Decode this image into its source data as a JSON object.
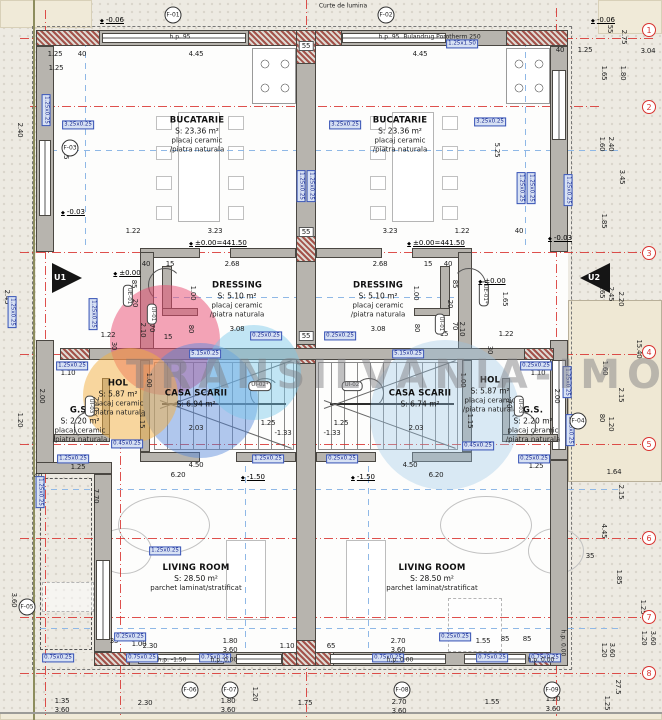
{
  "watermark": {
    "text": "TRANSILVANIA-IMOBILIARE",
    "circles": [
      {
        "x": 165,
        "y": 340,
        "d": 110,
        "c": "rgba(233,74,111,0.50)"
      },
      {
        "x": 200,
        "y": 400,
        "d": 115,
        "c": "rgba(82,133,219,0.45)"
      },
      {
        "x": 130,
        "y": 395,
        "d": 95,
        "c": "rgba(243,176,64,0.50)"
      },
      {
        "x": 253,
        "y": 372,
        "d": 95,
        "c": "rgba(120,200,235,0.45)"
      },
      {
        "x": 445,
        "y": 415,
        "d": 150,
        "c": "rgba(150,195,230,0.35)"
      }
    ]
  },
  "entrances": [
    {
      "label": "U1"
    },
    {
      "label": "U2"
    }
  ],
  "rooms": [
    {
      "name": "BUCATARIE",
      "area": "S: 23.36 m²",
      "f1": "placaj ceramic",
      "f2": "/piatra naturala",
      "x": 197,
      "y": 135
    },
    {
      "name": "BUCATARIE",
      "area": "S: 23.36 m²",
      "f1": "placaj ceramic",
      "f2": "/piatra naturala",
      "x": 400,
      "y": 135
    },
    {
      "name": "DRESSING",
      "area": "S: 5.10 m²",
      "f1": "placaj ceramic",
      "f2": "/piatra naturala",
      "x": 237,
      "y": 300
    },
    {
      "name": "DRESSING",
      "area": "S: 5.10 m²",
      "f1": "placaj ceramic",
      "f2": "/piatra naturala",
      "x": 378,
      "y": 300
    },
    {
      "name": "HOL",
      "area": "S: 5.87 m²",
      "f1": "placaj ceramic",
      "f2": "/piatra naturala",
      "x": 118,
      "y": 398
    },
    {
      "name": "HOL",
      "area": "S: 5.87 m²",
      "f1": "placaj ceramic",
      "f2": "/piatra naturala",
      "x": 490,
      "y": 395
    },
    {
      "name": "CASA SCARII",
      "area": "S: 6.94 m²",
      "x": 196,
      "y": 399
    },
    {
      "name": "CASA SCARII",
      "area": "S: 6.74 m²",
      "x": 420,
      "y": 399
    },
    {
      "name": "G.S.",
      "area": "S: 2.20 m²",
      "f1": "placaj ceramic",
      "f2": "/piatra naturala",
      "x": 80,
      "y": 425
    },
    {
      "name": "G.S.",
      "area": "S: 2.20 m²",
      "f1": "placaj ceramic",
      "f2": "/piatra naturala",
      "x": 533,
      "y": 425
    },
    {
      "name": "LIVING ROOM",
      "area": "S: 28.50 m²",
      "f1": "parchet laminat/stratificat",
      "x": 196,
      "y": 578
    },
    {
      "name": "LIVING ROOM",
      "area": "S: 28.50 m²",
      "f1": "parchet laminat/stratificat",
      "x": 432,
      "y": 578
    }
  ],
  "annot": {
    "dims": [
      [
        "1.25",
        55,
        54
      ],
      [
        "40",
        82,
        54
      ],
      [
        "4.45",
        196,
        54
      ],
      [
        "4.45",
        420,
        54
      ],
      [
        "40",
        560,
        50
      ],
      [
        "1.25",
        585,
        50
      ],
      [
        "3.04",
        648,
        51
      ],
      [
        "55",
        610,
        29,
        90
      ],
      [
        "2.75",
        624,
        37,
        90
      ],
      [
        "1.25",
        56,
        68
      ],
      [
        "1.65",
        604,
        73,
        90
      ],
      [
        "1.80",
        623,
        73,
        90
      ],
      [
        "1.60",
        602,
        144,
        90
      ],
      [
        "2.40",
        611,
        144,
        90
      ],
      [
        "3.45",
        622,
        177,
        90
      ],
      [
        "1.85",
        604,
        221,
        90
      ],
      [
        "1.65",
        602,
        291,
        90
      ],
      [
        "2.45",
        611,
        294,
        90
      ],
      [
        "2.20",
        621,
        299,
        90
      ],
      [
        "15.40",
        639,
        349,
        90
      ],
      [
        "1.60",
        605,
        368,
        90
      ],
      [
        "2.15",
        621,
        395,
        90
      ],
      [
        "80",
        602,
        418,
        90
      ],
      [
        "1.20",
        611,
        424,
        90
      ],
      [
        "1.64",
        614,
        472
      ],
      [
        "2.15",
        621,
        492,
        90
      ],
      [
        "4.45",
        604,
        531,
        90
      ],
      [
        "35",
        590,
        556
      ],
      [
        "1.85",
        619,
        577,
        90
      ],
      [
        "1.25",
        643,
        607,
        90
      ],
      [
        "1.20",
        604,
        650,
        90
      ],
      [
        "3.60",
        612,
        650,
        90
      ],
      [
        "27.5",
        618,
        687,
        90
      ],
      [
        "1.20",
        644,
        638,
        90
      ],
      [
        "3.60",
        653,
        638,
        90
      ],
      [
        "2.40",
        20,
        130,
        90
      ],
      [
        "2.45",
        7,
        297,
        90
      ],
      [
        "1.20",
        20,
        420,
        90
      ],
      [
        "2.00",
        42,
        396,
        90
      ],
      [
        "3.60",
        14,
        600,
        90
      ],
      [
        "7.70",
        96,
        496,
        90
      ],
      [
        "5.25",
        66,
        152,
        90
      ],
      [
        "5.25",
        497,
        150,
        90
      ],
      [
        "1.22",
        133,
        231
      ],
      [
        "3.23",
        215,
        231
      ],
      [
        "3.23",
        390,
        231
      ],
      [
        "1.22",
        462,
        231
      ],
      [
        "40",
        519,
        231
      ],
      [
        "40",
        146,
        264
      ],
      [
        "15",
        170,
        264
      ],
      [
        "2.68",
        232,
        264
      ],
      [
        "2.68",
        380,
        264
      ],
      [
        "15",
        428,
        264
      ],
      [
        "40",
        448,
        264
      ],
      [
        "1.00",
        193,
        293,
        90
      ],
      [
        "1.00",
        416,
        293,
        90
      ],
      [
        "85",
        134,
        284,
        90
      ],
      [
        "85",
        455,
        284,
        90
      ],
      [
        "20",
        135,
        303,
        90
      ],
      [
        "20",
        450,
        304,
        90
      ],
      [
        "2.10",
        143,
        330,
        90
      ],
      [
        "70",
        152,
        328,
        90
      ],
      [
        "80",
        191,
        329,
        90
      ],
      [
        "15",
        168,
        337
      ],
      [
        "80",
        417,
        328,
        90
      ],
      [
        "70",
        455,
        326,
        90
      ],
      [
        "2.10",
        462,
        329,
        90
      ],
      [
        "15",
        444,
        334
      ],
      [
        "1.65",
        505,
        299,
        90
      ],
      [
        "1.22",
        108,
        335
      ],
      [
        "1.22",
        506,
        334
      ],
      [
        "3.08",
        237,
        329
      ],
      [
        "3.08",
        378,
        329
      ],
      [
        "30",
        114,
        346,
        90
      ],
      [
        "30",
        490,
        350,
        90
      ],
      [
        "1.10",
        68,
        373
      ],
      [
        "1.10",
        538,
        373
      ],
      [
        "1.00",
        149,
        380,
        90
      ],
      [
        "1.00",
        463,
        380,
        90
      ],
      [
        "1.15",
        142,
        421,
        90
      ],
      [
        "1.15",
        470,
        421,
        90
      ],
      [
        "2.00",
        557,
        396,
        90
      ],
      [
        "2.10",
        96,
        404,
        90
      ],
      [
        "2.10",
        517,
        404,
        90
      ],
      [
        "70",
        509,
        404,
        90
      ],
      [
        "2.03",
        196,
        428
      ],
      [
        "2.03",
        416,
        428
      ],
      [
        "1.25",
        268,
        423
      ],
      [
        "1.25",
        341,
        423
      ],
      [
        "-1.33",
        283,
        433
      ],
      [
        "-1.33",
        332,
        433
      ],
      [
        "1.25",
        78,
        467
      ],
      [
        "1.25",
        536,
        466
      ],
      [
        "4.50",
        196,
        465
      ],
      [
        "6.20",
        178,
        475
      ],
      [
        "4.50",
        410,
        465
      ],
      [
        "6.20",
        436,
        475
      ],
      [
        "40",
        38,
        476
      ],
      [
        "35",
        114,
        641
      ],
      [
        "1.00",
        139,
        644
      ],
      [
        "2.30",
        150,
        646
      ],
      [
        "1.80",
        230,
        641
      ],
      [
        "3.60",
        230,
        650
      ],
      [
        "1.10",
        287,
        646
      ],
      [
        "65",
        331,
        646
      ],
      [
        "2.70",
        398,
        641
      ],
      [
        "3.60",
        398,
        650
      ],
      [
        "1.55",
        483,
        641
      ],
      [
        "85",
        505,
        639
      ],
      [
        "85",
        527,
        639
      ],
      [
        "1.35",
        62,
        701
      ],
      [
        "3.60",
        62,
        710
      ],
      [
        "2.30",
        145,
        703
      ],
      [
        "1.80",
        228,
        701
      ],
      [
        "3.60",
        228,
        710
      ],
      [
        "1.20",
        255,
        694,
        90
      ],
      [
        "1.75",
        305,
        703
      ],
      [
        "2.70",
        399,
        702
      ],
      [
        "3.60",
        399,
        711
      ],
      [
        "1.55",
        492,
        702
      ],
      [
        "1.20",
        553,
        699
      ],
      [
        "3.60",
        553,
        709
      ],
      [
        "1.25",
        607,
        703,
        90
      ]
    ],
    "boxed": [
      [
        "55",
        306,
        46
      ],
      [
        "55",
        306,
        232
      ],
      [
        "55",
        306,
        336
      ]
    ],
    "beam_tags": [
      [
        "3.25x0.25",
        78,
        125
      ],
      [
        "3.25x0.25",
        345,
        125
      ],
      [
        "3.25x0.25",
        490,
        122
      ],
      [
        "1.25x1.50",
        462,
        44
      ],
      [
        "1.25x0.25",
        46,
        110,
        90
      ],
      [
        "1.25x0.25",
        301,
        186,
        90
      ],
      [
        "1.25x0.25",
        311,
        186,
        90
      ],
      [
        "1.25x0.25",
        521,
        188,
        90
      ],
      [
        "1.25x0.25",
        531,
        188,
        90
      ],
      [
        "1.25x0.25",
        568,
        190,
        90
      ],
      [
        "1.25x0.25",
        12,
        312,
        90
      ],
      [
        "1.25x0.25",
        93,
        314,
        90
      ],
      [
        "1.25x0.25",
        72,
        366
      ],
      [
        "0.25x0.25",
        536,
        366
      ],
      [
        "0.25x0.25",
        266,
        336
      ],
      [
        "0.25x0.25",
        340,
        336
      ],
      [
        "5.15x0.25",
        205,
        354
      ],
      [
        "5.15x0.25",
        408,
        354
      ],
      [
        "0.45x0.25",
        127,
        444
      ],
      [
        "0.45x0.25",
        478,
        446
      ],
      [
        "1.25x0.25",
        73,
        459
      ],
      [
        "0.25x0.25",
        534,
        459
      ],
      [
        "1.25x0.25",
        268,
        459
      ],
      [
        "0.25x0.25",
        342,
        459
      ],
      [
        "1.25x0.25",
        567,
        382,
        90
      ],
      [
        "1.25x0.25",
        570,
        430,
        90
      ],
      [
        "1.25x0.25",
        40,
        492,
        90
      ],
      [
        "1.25x0.25",
        165,
        551
      ],
      [
        "0.25x0.25",
        130,
        637
      ],
      [
        "0.25x0.25",
        455,
        637
      ],
      [
        "0.75x0.25",
        58,
        658
      ],
      [
        "0.75x0.25",
        142,
        658
      ],
      [
        "0.75x0.25",
        215,
        658
      ],
      [
        "0.75x0.25",
        388,
        658
      ],
      [
        "0.75x0.25",
        492,
        658
      ],
      [
        "0.75x0.25",
        545,
        658
      ]
    ],
    "door_tags": [
      [
        "UI-02*",
        260,
        386
      ],
      [
        "UI-02",
        352,
        386
      ],
      [
        "UI-01",
        152,
        314,
        90
      ],
      [
        "UI-01",
        440,
        324,
        90
      ],
      [
        "UE-01",
        128,
        296,
        90
      ],
      [
        "UE-01*",
        484,
        294,
        90
      ],
      [
        "UI-03",
        90,
        406,
        90
      ],
      [
        "UI-03",
        519,
        406,
        90
      ]
    ],
    "elev": [
      [
        "-0.06",
        112,
        20
      ],
      [
        "-0.06",
        603,
        20
      ],
      [
        "±0.00=441.50",
        218,
        243
      ],
      [
        "±0.00=441.50",
        436,
        243
      ],
      [
        "-0.03",
        73,
        212
      ],
      [
        "-0.03",
        560,
        238
      ],
      [
        "±0.00",
        127,
        273
      ],
      [
        "±0.00",
        492,
        281
      ],
      [
        "-1.50",
        253,
        477
      ],
      [
        "-1.50",
        363,
        477
      ]
    ],
    "notes": [
      [
        "Curte de lumina",
        343,
        6
      ],
      [
        "Bulandrug Porotherm 250",
        442,
        37
      ],
      [
        "h.p. 95",
        180,
        37
      ],
      [
        "h.p. 95",
        389,
        37
      ],
      [
        "h.p. -1.50",
        172,
        660
      ],
      [
        "h.p. 0.00",
        224,
        660
      ],
      [
        "h.p. 0.00",
        400,
        660
      ],
      [
        "h.p. 0.00",
        541,
        660
      ],
      [
        "h.p. 0.00",
        563,
        643,
        90
      ]
    ],
    "axes": [
      [
        "1",
        649,
        30
      ],
      [
        "2",
        649,
        107
      ],
      [
        "3",
        649,
        253
      ],
      [
        "4",
        649,
        352
      ],
      [
        "5",
        649,
        444
      ],
      [
        "6",
        649,
        538
      ],
      [
        "7",
        649,
        617
      ],
      [
        "8",
        649,
        673
      ]
    ],
    "fmarks": [
      [
        "F-01",
        173,
        15
      ],
      [
        "F-02",
        386,
        15
      ],
      [
        "F-03",
        70,
        148
      ],
      [
        "F-04",
        578,
        421
      ],
      [
        "F-05",
        27,
        607
      ],
      [
        "F-06",
        190,
        690
      ],
      [
        "F-07",
        230,
        690
      ],
      [
        "F-08",
        402,
        690
      ],
      [
        "F-09",
        552,
        690
      ]
    ]
  }
}
